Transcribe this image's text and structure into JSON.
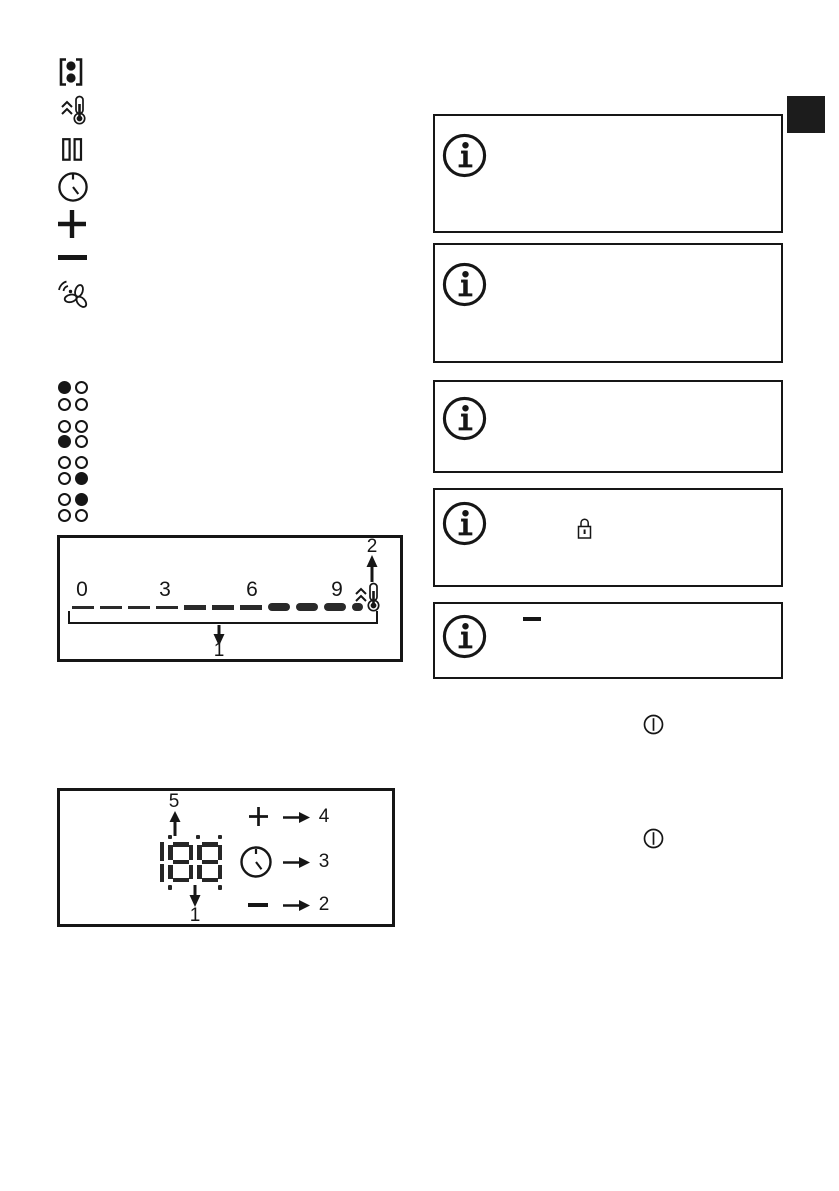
{
  "page": {
    "background": "#ffffff",
    "ink_color": "#161616"
  },
  "left_icon_column": {
    "icons": [
      {
        "name": "bridge-function-icon"
      },
      {
        "name": "heat-up-thermometer-icon"
      },
      {
        "name": "pause-icon"
      },
      {
        "name": "clock-icon"
      },
      {
        "name": "plus-icon"
      },
      {
        "name": "minus-icon"
      },
      {
        "name": "fan-icon"
      }
    ]
  },
  "indicator_grid": {
    "columns": 2,
    "rows": [
      [
        1,
        0
      ],
      [
        0,
        0
      ],
      [
        0,
        0
      ],
      [
        1,
        0
      ],
      [
        0,
        0
      ],
      [
        0,
        1
      ],
      [
        0,
        1
      ],
      [
        0,
        0
      ]
    ]
  },
  "figure1": {
    "type": "power-level-scale-diagram",
    "scale_labels": [
      "0",
      "3",
      "6",
      "9"
    ],
    "segment_count": 11,
    "segment_thickness": [
      "thin",
      "thin",
      "thin",
      "thin",
      "medium",
      "medium",
      "medium",
      "thick",
      "thick",
      "thick",
      "thick"
    ],
    "end_icon": "heat-up-thermometer-icon",
    "callout_top_right": "2",
    "callout_bottom": "1"
  },
  "figure2": {
    "type": "timer-display-diagram",
    "display_value": "188",
    "display_dots": {
      "top": [
        1,
        2,
        3
      ],
      "bottom": [
        1,
        3
      ]
    },
    "callout_top": "5",
    "callout_bottom": "1",
    "legend_rows": [
      {
        "icon": "plus-icon",
        "label": "4"
      },
      {
        "icon": "clock-icon",
        "label": "3"
      },
      {
        "icon": "minus-icon",
        "label": "2"
      }
    ]
  },
  "info_boxes": [
    {
      "icon": "info-icon",
      "inline_icon": null
    },
    {
      "icon": "info-icon",
      "inline_icon": null
    },
    {
      "icon": "info-icon",
      "inline_icon": null
    },
    {
      "icon": "info-icon",
      "inline_icon": "lock-icon"
    },
    {
      "icon": "info-icon",
      "inline_icon": "minus-dash"
    }
  ],
  "power_symbols": [
    {
      "name": "power-on-off-icon"
    },
    {
      "name": "power-on-off-icon"
    }
  ],
  "edge_tab": {
    "color": "#1c1c1c"
  }
}
